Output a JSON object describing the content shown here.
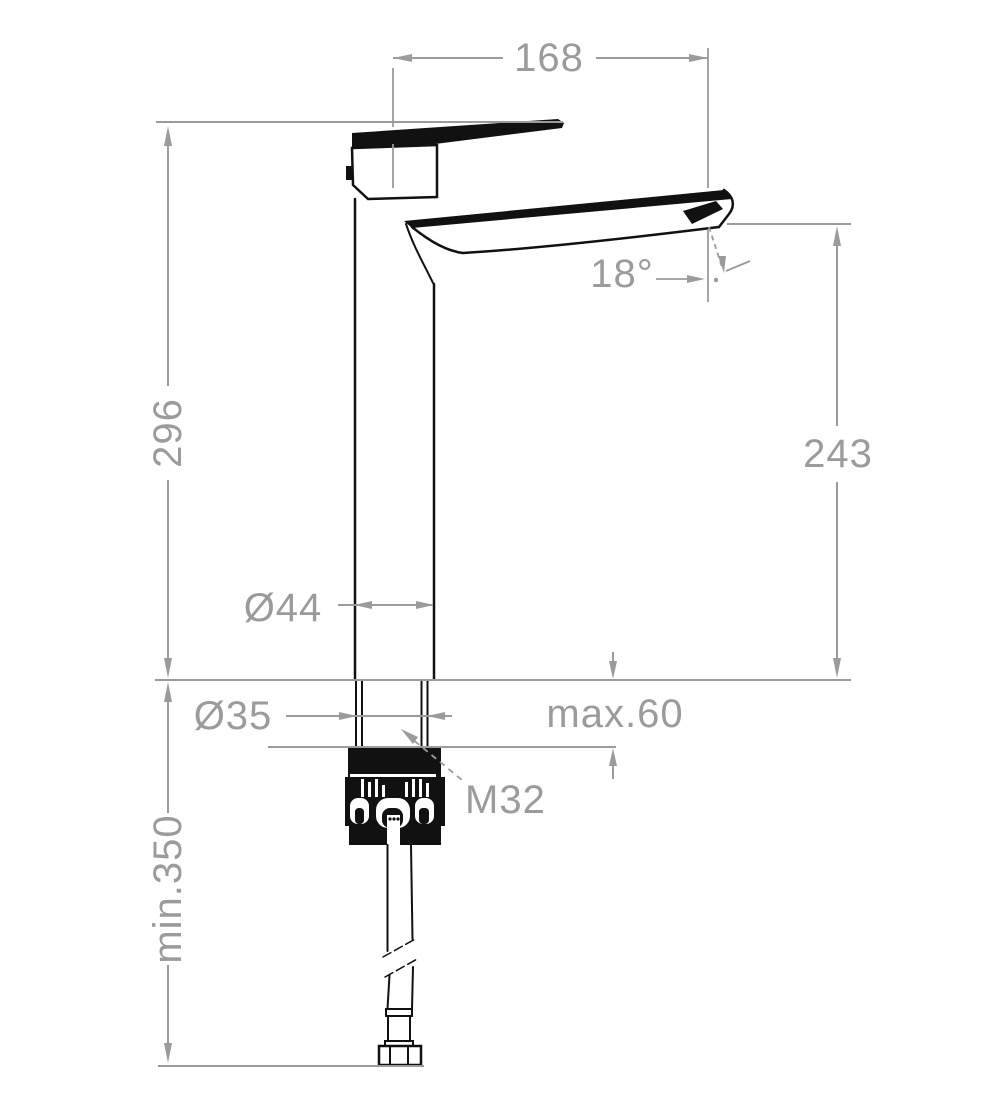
{
  "drawing": {
    "title": "Tall single-lever basin mixer — dimensional drawing",
    "units": "mm",
    "colors": {
      "dimension_gray": "#9b9b9b",
      "outline_black": "#111111",
      "background": "#ffffff"
    },
    "labels": {
      "spout_reach": "168",
      "overall_height": "296",
      "spout_height": "243",
      "spout_angle": "18°",
      "body_diameter": "Ø44",
      "shank_diameter": "Ø35",
      "max_deck_thickness": "max.60",
      "thread_size": "M32",
      "min_hose_clearance": "min.350"
    }
  }
}
